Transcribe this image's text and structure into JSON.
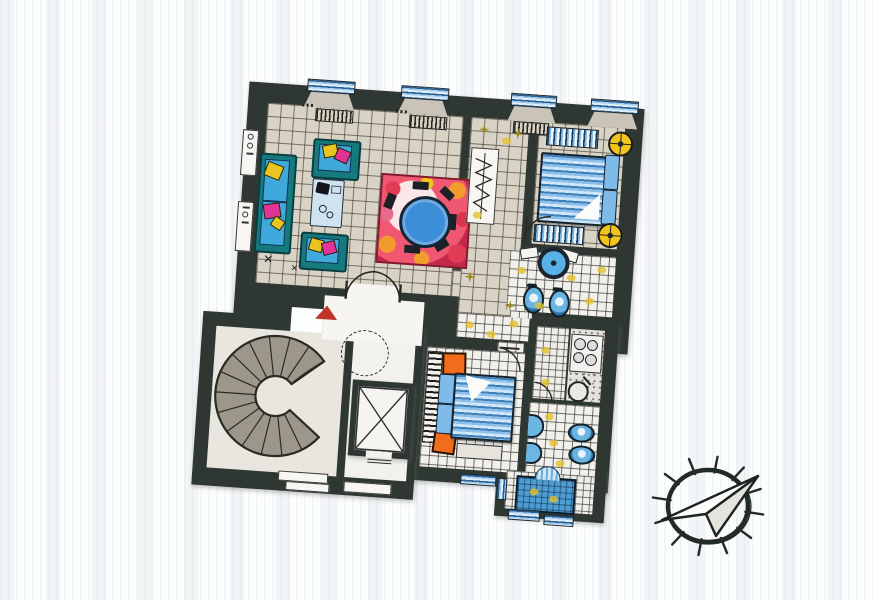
{
  "drawing": {
    "type": "apartment-floor-plan",
    "style": "hand-colored marker sketch on scanned white paper",
    "orientation_note": "plan tilted clockwise a few degrees; compass rose at lower right pointing north-east"
  },
  "colors": {
    "paper": "#fcfdfd",
    "wall": "#2f3733",
    "tile-beige": "#d9d3c5",
    "tile-white": "#f2f0ea",
    "stair": "#9d968a",
    "sofa-teal": "#157a7e",
    "seat-blue": "#3fa9dc",
    "pillow-pink": "#e43397",
    "pillow-yellow": "#e9c51f",
    "bed-light": "#7fbbe8",
    "nightstand-orange": "#f26d1b",
    "fixture-blue": "#5bb2e4",
    "rug-red": "#e0485f",
    "rug-orange": "#f0982e",
    "table-blue": "#3d8ed8",
    "lamp": "#f2c51c",
    "entrance-arrow-red": "#c03428",
    "accent-yellow": "#e4c22e",
    "ink": "#20261f"
  },
  "rooms": [
    {
      "name": "living-room",
      "floor": "beige-tile-grid",
      "furniture": [
        "sofa",
        "armchair",
        "armchair",
        "coffee-table",
        "dining-rug",
        "round-dining-table",
        "dining-chairs",
        "window-radiator",
        "window-radiator"
      ]
    },
    {
      "name": "hallway",
      "floor": "beige-tile-grid",
      "furniture": [
        "wardrobe"
      ],
      "accents": [
        "yellow-star-tiles"
      ]
    },
    {
      "name": "bedroom-1",
      "floor": "beige-tile-grid",
      "furniture": [
        "double-bed",
        "bench",
        "bench",
        "round-lamp",
        "round-lamp"
      ]
    },
    {
      "name": "wc",
      "floor": "white-tile-grid",
      "furniture": [
        "niche-washbasin",
        "toilet",
        "bidet"
      ],
      "accents": [
        "yellow-tiles"
      ]
    },
    {
      "name": "corridor",
      "floor": "white-tile-grid",
      "accents": [
        "yellow-tiles"
      ]
    },
    {
      "name": "kitchen",
      "floor": "white-tile-grid",
      "furniture": [
        "counter",
        "stove-four-burners",
        "round-sink"
      ]
    },
    {
      "name": "bathroom",
      "floor": "white-tile-grid",
      "furniture": [
        "washbasin",
        "washbasin",
        "toilet",
        "bidet"
      ],
      "accents": [
        "yellow-tiles"
      ]
    },
    {
      "name": "bedroom-2",
      "floor": "white-tile-grid",
      "furniture": [
        "double-bed",
        "nightstand",
        "nightstand",
        "striped-runner",
        "bench"
      ]
    },
    {
      "name": "shower-room",
      "floor": "white-tile-grid",
      "furniture": [
        "shower-tray",
        "scallop-washbasin"
      ]
    },
    {
      "name": "stairwell",
      "floor": "plain",
      "furniture": [
        "spiral-staircase",
        "elevator-shaft",
        "entry-steps"
      ]
    },
    {
      "name": "entrance-hall",
      "floor": "plain",
      "furniture": [
        "double-entrance-door",
        "red-entrance-arrow",
        "dashed-oval-opening"
      ]
    }
  ],
  "windows": {
    "top_edge": 4,
    "bottom_edge": 3,
    "left_wall_labels": 2
  },
  "symbols": {
    "compass-rose": "circle with radial ticks and paper-plane arrow to upper right",
    "entrance-arrow": "red triangle pointing up"
  }
}
